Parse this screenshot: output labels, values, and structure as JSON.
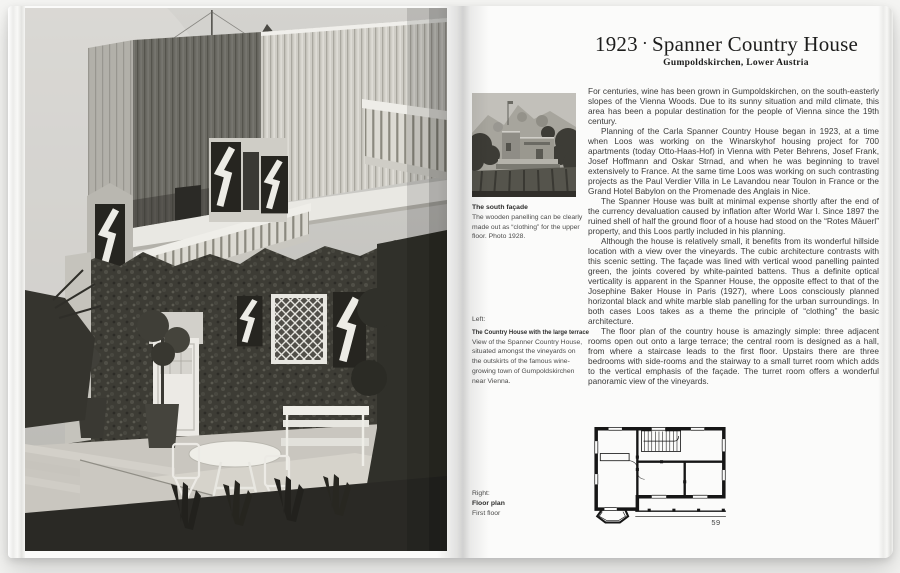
{
  "colors": {
    "paper": "#fbfbfa",
    "body_text": "#3b3b3a",
    "photo_grey": "#bdbcb7"
  },
  "page": {
    "header": {
      "year": "1923",
      "separator": "·",
      "title": "Spanner Country House",
      "subtitle": "Gumpoldskirchen, Lower Austria"
    },
    "body": {
      "paragraphs": [
        "For centuries, wine has been grown in Gumpoldskirchen, on the south-easterly slopes of the Vienna Woods. Due to its sunny situation and mild climate, this area has been a popular destination for the people of Vienna since the 19th century.",
        "Planning of the Carla Spanner Country House began in 1923, at a time when Loos was working on the Winarskyhof housing project for 700 apartments (today Otto-Haas-Hof) in Vienna with Peter Behrens, Josef Frank, Josef Hoffmann and Oskar Strnad, and when he was beginning to travel extensively to France. At the same time Loos was working on such contrasting projects as the Paul Verdier Villa in Le Lavandou near Toulon in France or the Grand Hotel Babylon on the Promenade des Anglais in Nice.",
        "The Spanner House was built at minimal expense shortly after the end of the currency devaluation caused by inflation after World War I. Since 1897 the ruined shell of half the ground floor of a house had stood on the “Rotes Mäuerl” property, and this Loos partly included in his planning.",
        "Although the house is relatively small, it benefits from its wonderful hillside location with a view over the vineyards. The cubic architecture contrasts with this scenic setting. The façade was lined with vertical wood panelling painted green, the joints covered by white-painted battens. Thus a definite optical verticality is apparent in the Spanner House, the opposite effect to that of the Josephine Baker House in Paris (1927), where Loos consciously planned horizontal black and white marble slab panelling for the urban surroundings. In both cases Loos takes as a theme the principle of “clothing” the basic architecture.",
        "The floor plan of the country house is amazingly simple: three adjacent rooms open out onto a large terrace; the central room is designed as a hall, from where a staircase leads to the first floor. Upstairs there are three bedrooms with side-rooms and the stairway to a small turret room which adds to the vertical emphasis of the façade. The turret room offers a wonderful panoramic view of the vineyards."
      ]
    },
    "captions": {
      "south_facade": {
        "title": "The south façade",
        "body": "The wooden panelling can be clearly made out as “clothing” for the upper floor. Photo 1928."
      },
      "terrace": {
        "prefix": "Left:",
        "title": "The Country House with the large terrace",
        "body": "View of the Spanner Country House, situated amongst the vineyards on the outskirts of the famous wine-growing town of Gumpoldskirchen near Vienna."
      },
      "floor_plan": {
        "prefix": "Right:",
        "title": "Floor plan",
        "body": "First floor"
      }
    },
    "footer": {
      "page_number": "59"
    }
  }
}
